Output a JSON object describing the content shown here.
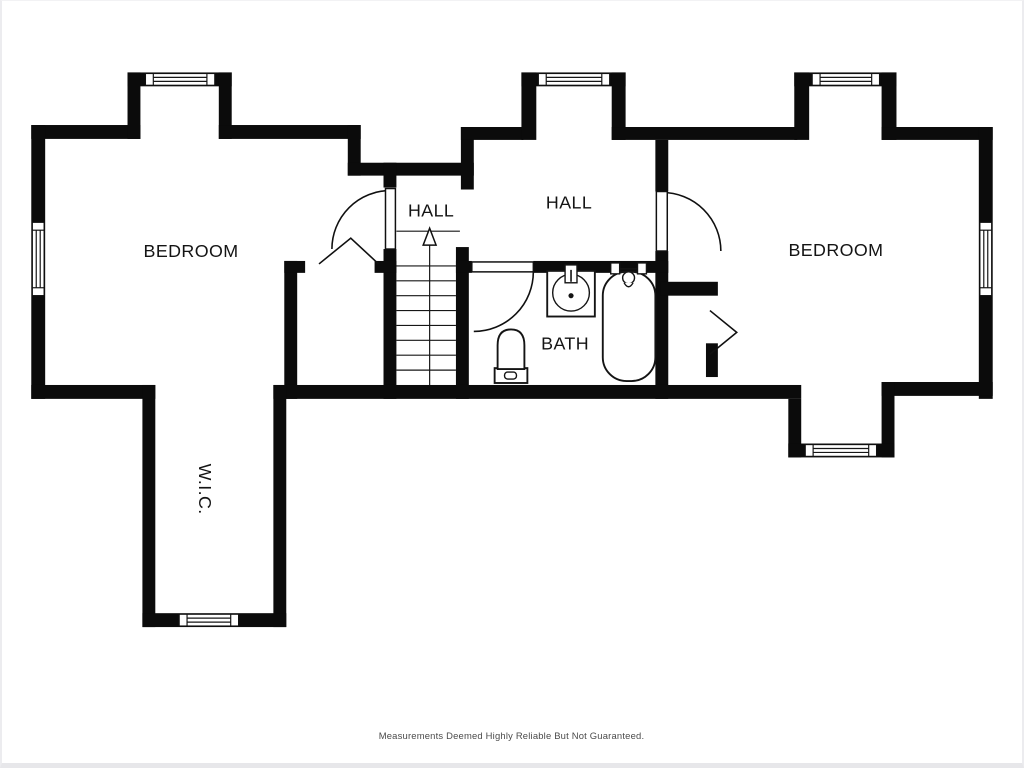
{
  "document": {
    "type": "second-floor floor plan",
    "background_color": "#ffffff",
    "wall_color": "#0b0b0b",
    "label_color": "#141414",
    "disclaimer_color": "#4b4b4b"
  },
  "rooms": {
    "bedroom_left": {
      "label": "BEDROOM"
    },
    "bedroom_right": {
      "label": "BEDROOM"
    },
    "hall_upper": {
      "label": "HALL"
    },
    "hall_main": {
      "label": "HALL"
    },
    "bath": {
      "label": "BATH"
    },
    "wic": {
      "label": "W.I.C."
    }
  },
  "fixtures": {
    "bath": [
      "sink",
      "toilet",
      "bathtub"
    ]
  },
  "stairs": {
    "direction": "up",
    "tread_count": 8
  },
  "symbols": {
    "window_count": 7,
    "swing_door_count": 3,
    "bifold_door_count": 1,
    "closet_chevron_door_count": 1
  },
  "footer": {
    "disclaimer": "Measurements Deemed Highly Reliable But Not Guaranteed."
  }
}
